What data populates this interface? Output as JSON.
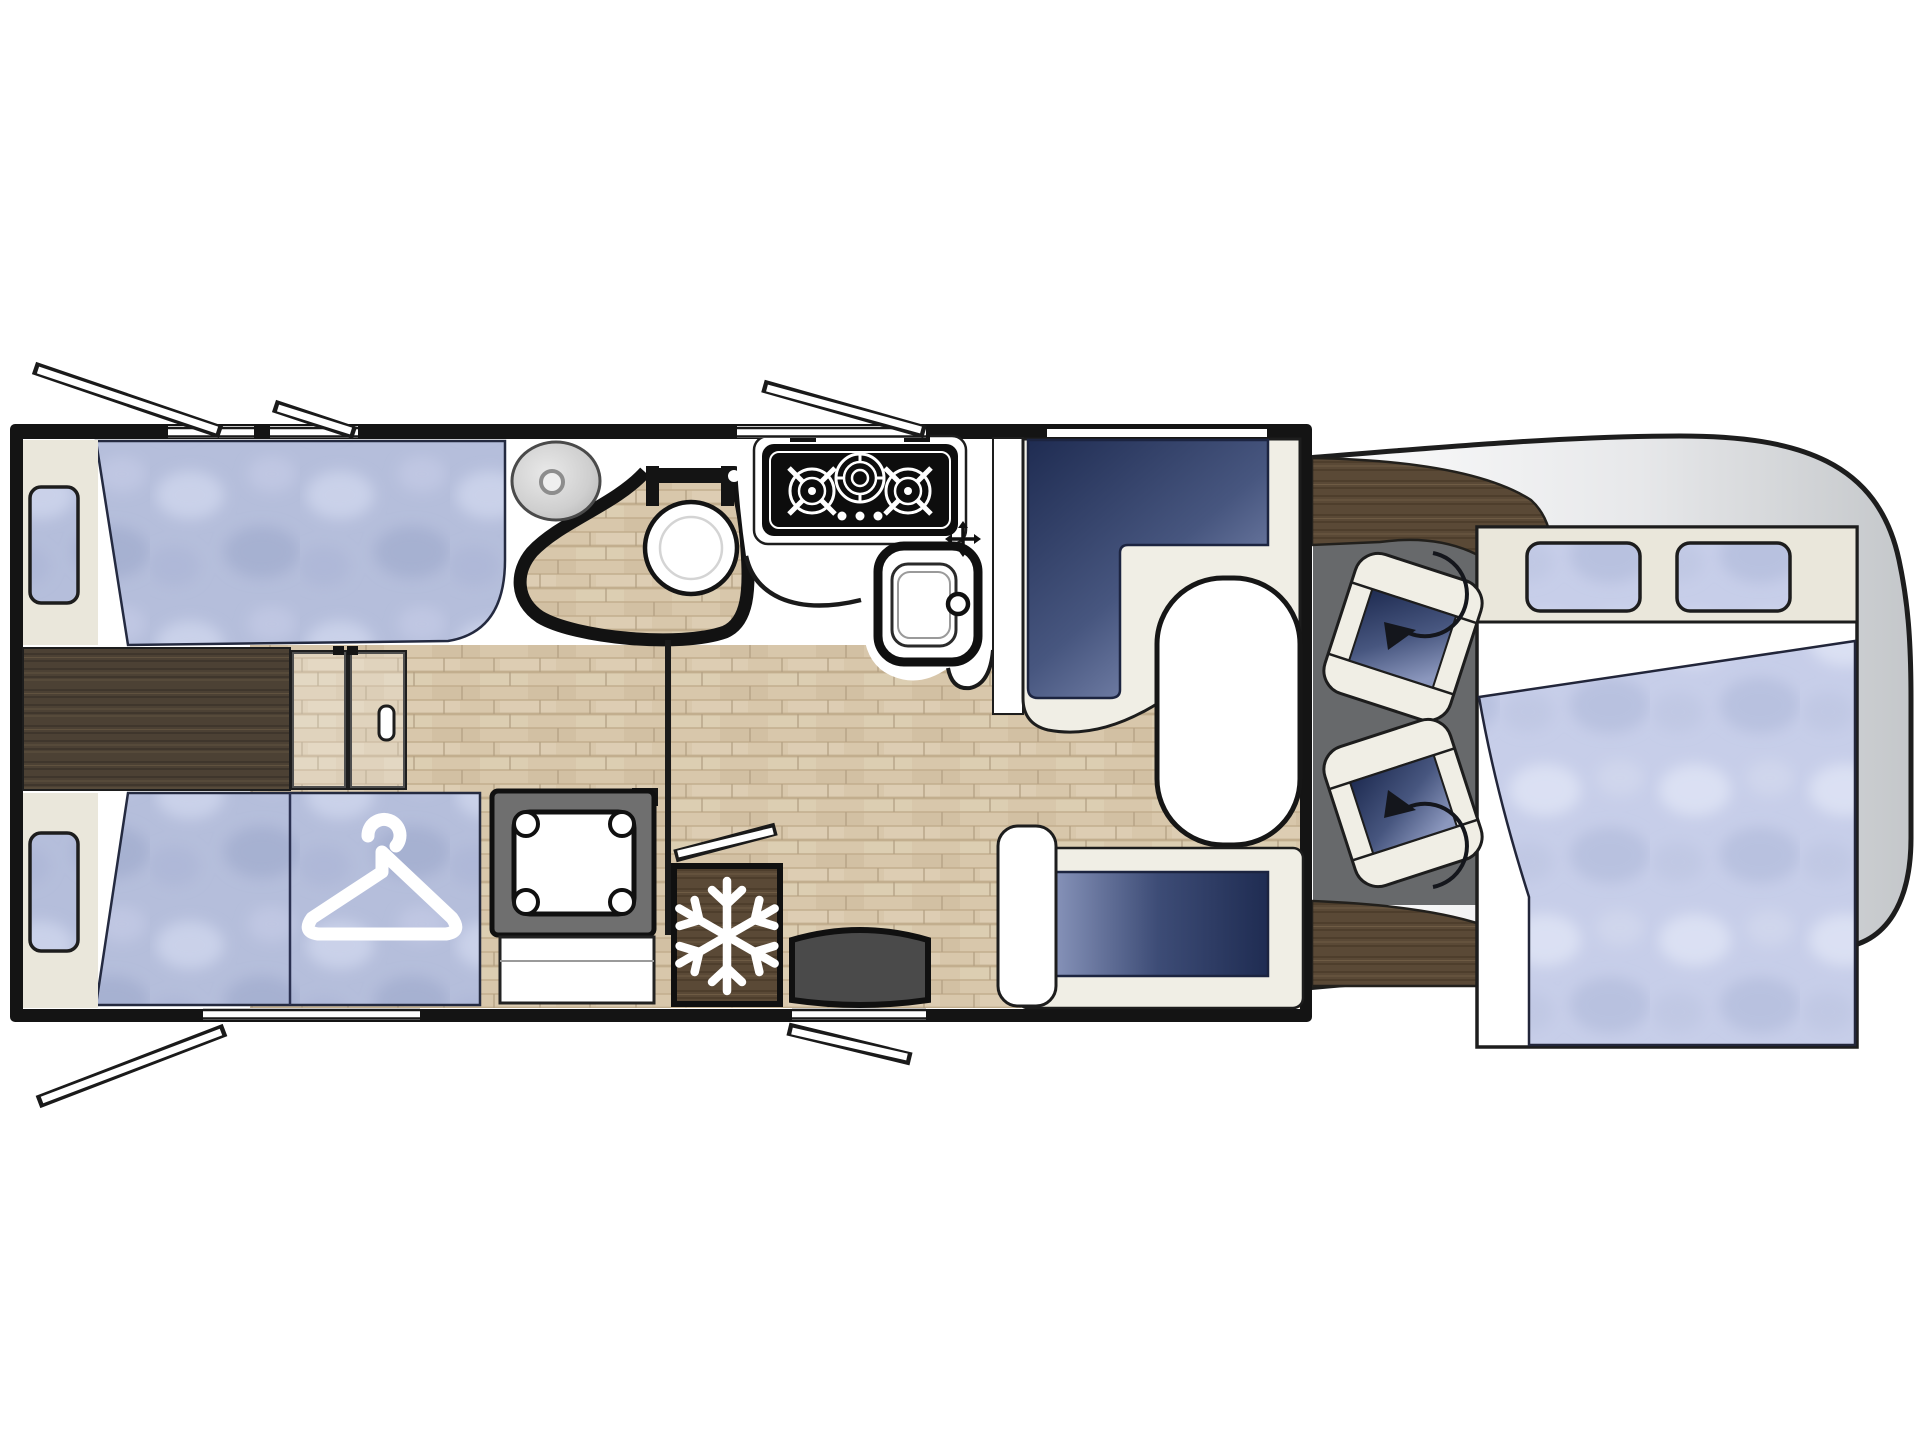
{
  "meta": {
    "type": "motorhome-floorplan",
    "description": "Top-view floor plan of a motorhome: rear twin single beds with wardrobe, central washroom with round shower enclosure and toilet, galley kitchen with 3-burner hob and sink, refrigerator, L-shaped dinette with oval table and bench seat, two swivel cab seats and front drop-down bed",
    "visible_text": []
  },
  "palette": {
    "outline": "#1a1a1a",
    "wall": "#141414",
    "interior": "#ffffff",
    "floor_light_base": "#d8c7ab",
    "floor_dark_base": "#4c4134",
    "wood_brown_base": "#5a4936",
    "cream": "#eae7db",
    "seat_cream": "#f0eee5",
    "fabric_blue": "#b5bedb",
    "fabric_blue_light": "#c7cee9",
    "navy_dark": "#1f2c52",
    "navy_light": "#8b97bd",
    "body_gray": "#c7cacd",
    "cab_floor_gray": "#67696b",
    "step_gray": "#4a4a4a",
    "basin_gray": "#cfcfcf"
  },
  "icons": [
    {
      "name": "hanger-icon",
      "meaning": "wardrobe storage"
    },
    {
      "name": "snowflake-icon",
      "meaning": "refrigerator"
    },
    {
      "name": "swivel-arrow-icon",
      "meaning": "rotating cab seat"
    },
    {
      "name": "burner-icon",
      "meaning": "gas hob burner"
    },
    {
      "name": "faucet-cross-icon",
      "meaning": "sink tap"
    }
  ],
  "zones": [
    {
      "name": "rear-bedroom",
      "features": [
        "twin-bed-top",
        "twin-bed-bottom",
        "wardrobe-under-bed",
        "step-chest",
        "sliding-door",
        "side-window-top",
        "side-window-bottom"
      ]
    },
    {
      "name": "washroom",
      "features": [
        "washbasin",
        "shower-enclosure",
        "toilet"
      ]
    },
    {
      "name": "kitchen",
      "features": [
        "hob-3-burner",
        "sink",
        "refrigerator",
        "heater-unit"
      ]
    },
    {
      "name": "lounge",
      "features": [
        "l-shaped-dinette",
        "oval-table",
        "bench-seat",
        "entry-door",
        "entry-step"
      ]
    },
    {
      "name": "cab",
      "features": [
        "driver-swivel-seat",
        "passenger-swivel-seat",
        "dashboard",
        "drop-down-bed",
        "front-bed-windows"
      ]
    }
  ]
}
